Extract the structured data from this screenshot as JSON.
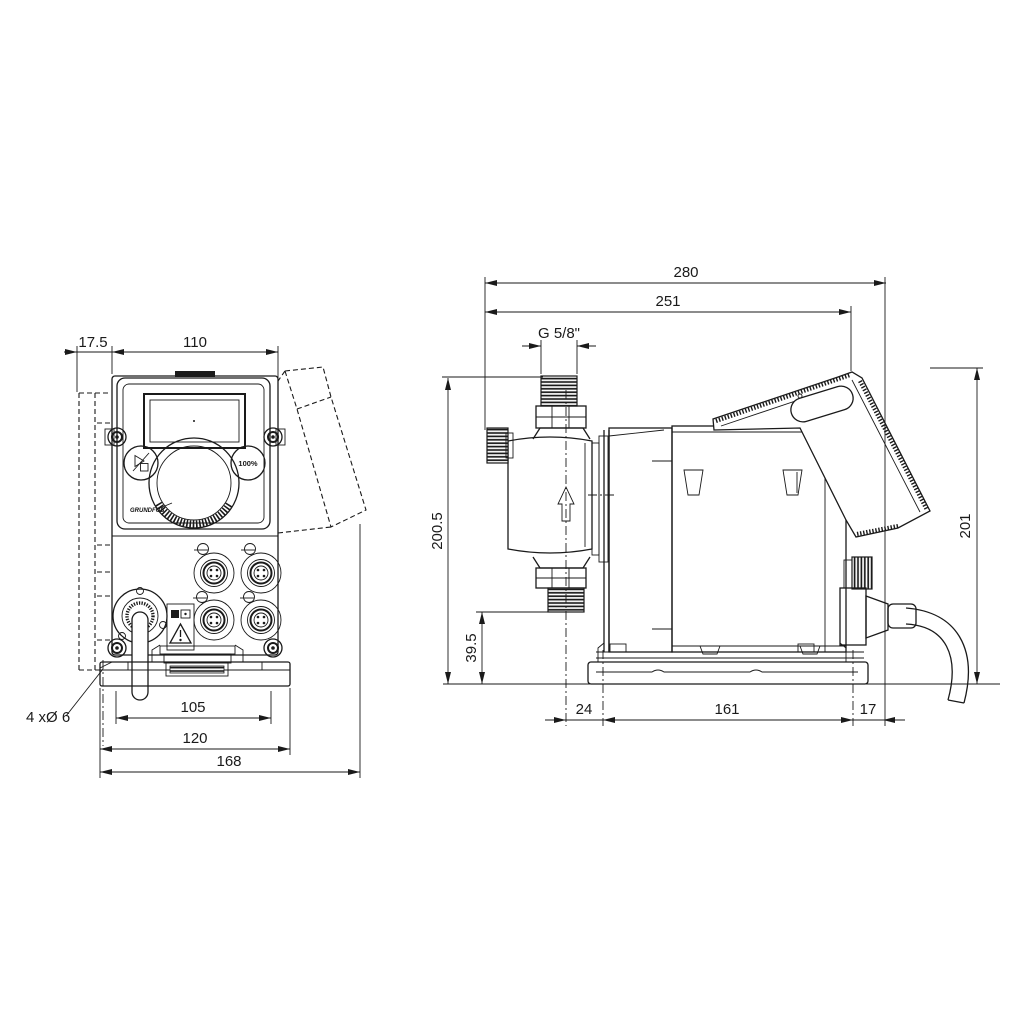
{
  "page": {
    "background": "#ffffff",
    "line_color": "#1a1a1a"
  },
  "front_view": {
    "dims": {
      "offset": "17.5",
      "width": "110",
      "hole_pitch": "105",
      "plate_width": "120",
      "overall_width": "168"
    },
    "note_holes": "4 xØ 6",
    "controls": {
      "percent_button": "100%",
      "logo": "GRUNDFOS"
    }
  },
  "side_view": {
    "dims": {
      "overall_length": "280",
      "length_to_cover": "251",
      "thread": "G 5/8\"",
      "height_connection": "200.5",
      "height_overall": "201",
      "valve_height": "39.5",
      "base_offset_front": "24",
      "base_length": "161",
      "base_offset_rear": "17"
    }
  }
}
